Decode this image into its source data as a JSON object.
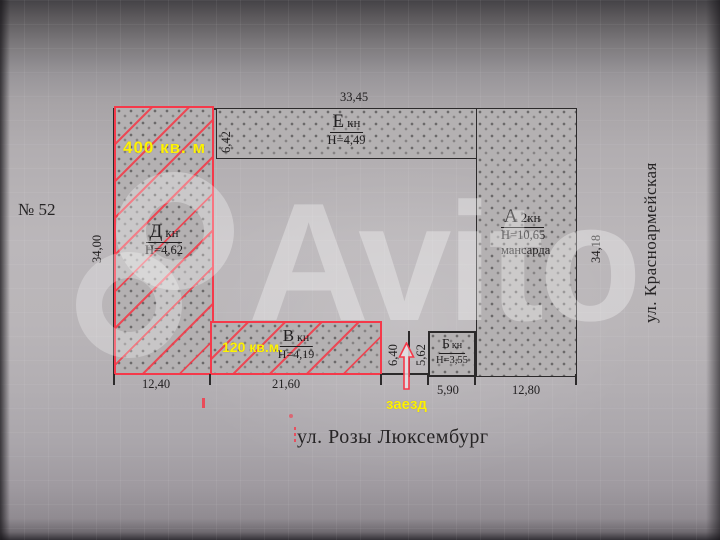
{
  "watermark": {
    "text": "Avito"
  },
  "plan": {
    "plot_number": "№ 52",
    "street_bottom": "ул. Розы Люксембург",
    "street_right": "ул. Красноармейская",
    "entrance": "заезд",
    "buildings": [
      {
        "letter": "Д",
        "type": "кн",
        "height": "Н=4,62",
        "area": "400 кв. м"
      },
      {
        "letter": "Е",
        "type": "кн",
        "height": "Н=4,49"
      },
      {
        "letter": "А",
        "type": "2кн",
        "height": "Н=10,65",
        "note": "мансарда"
      },
      {
        "letter": "Б",
        "type": "кн",
        "height": "Н=3,55"
      },
      {
        "letter": "В",
        "type": "кн",
        "height": "Н=4,19",
        "area": "120 кв.м."
      }
    ],
    "dimensions": {
      "top": "33,45",
      "left": "34,00",
      "right": "34,18",
      "bottom_d": "12,40",
      "bottom_v": "21,60",
      "bottom_b": "5,90",
      "bottom_a": "12,80",
      "e_h": "6,42",
      "v_h": "6,40",
      "b_h": "5,62"
    }
  },
  "colors": {
    "red": "#f5394a",
    "yellow": "#fcf303",
    "ink": "#211f20"
  }
}
